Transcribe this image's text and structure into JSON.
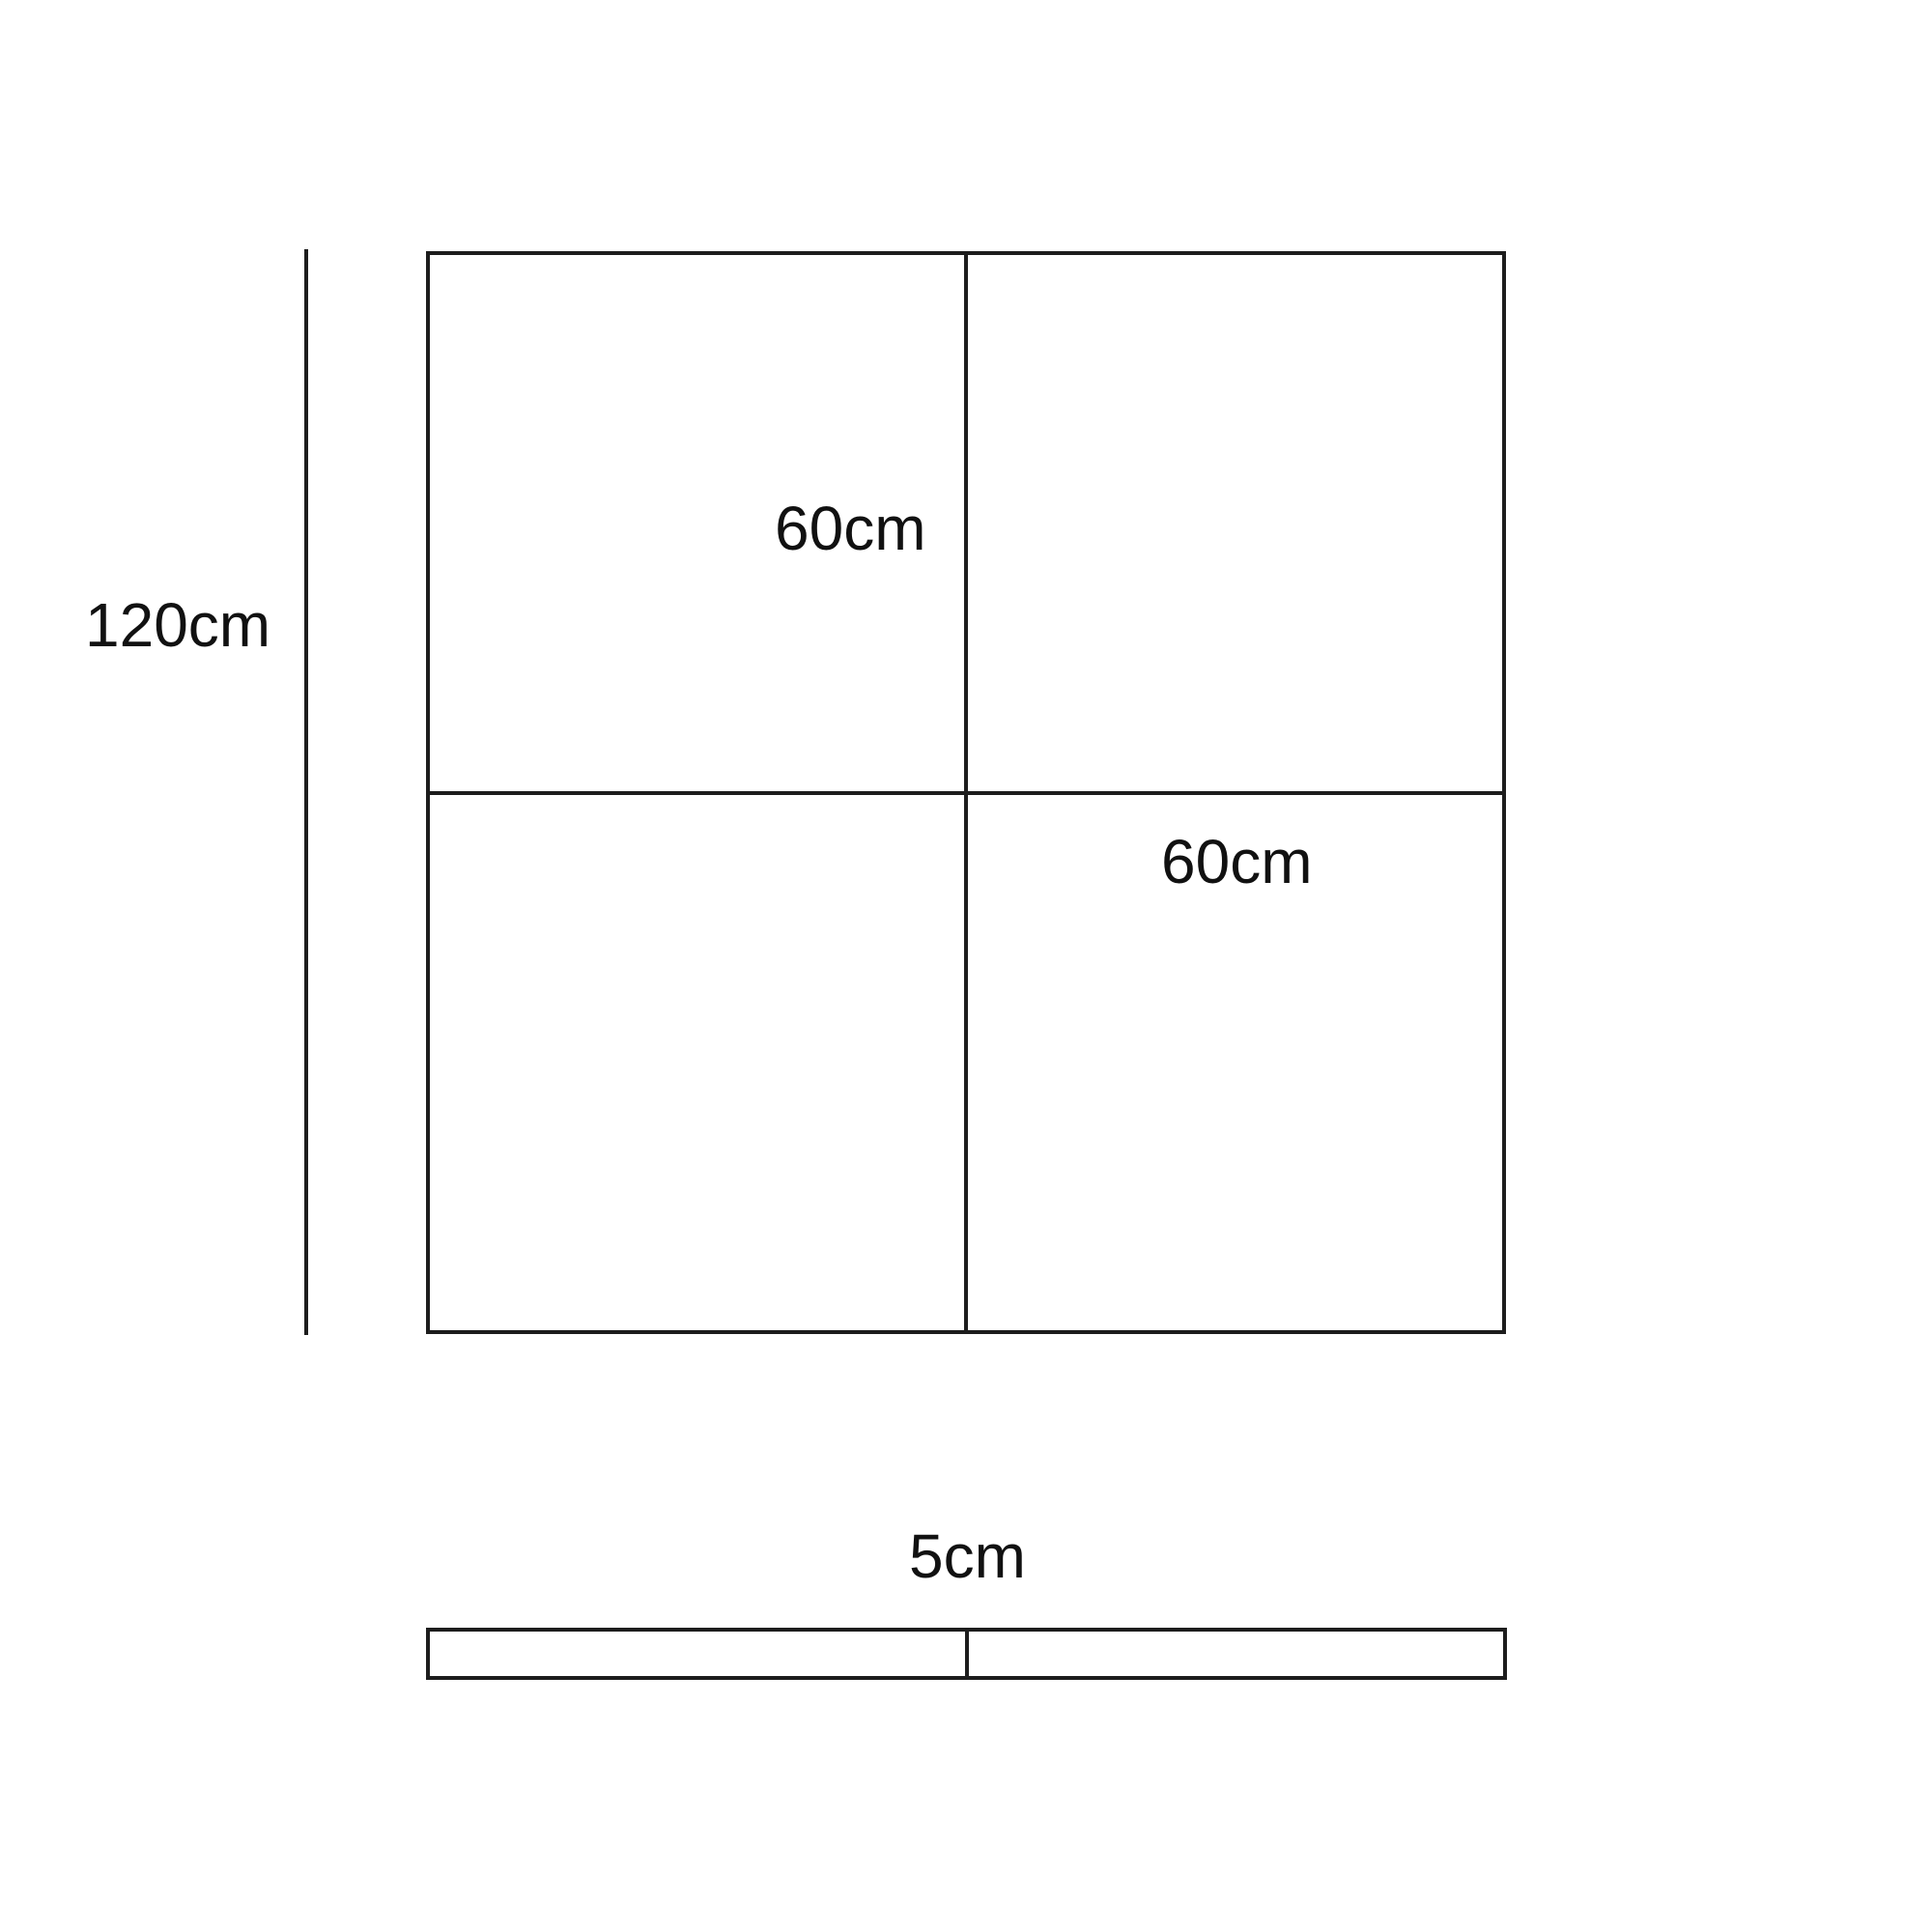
{
  "page": {
    "background": "#ffffff",
    "line_color": "#1d1d1d",
    "text_color": "#111111"
  },
  "diagram": {
    "front_view": {
      "overall_height_label": "120cm",
      "top_tile_label": "60cm",
      "bottom_tile_label": "60cm"
    },
    "side_view": {
      "thickness_label": "5cm"
    }
  }
}
